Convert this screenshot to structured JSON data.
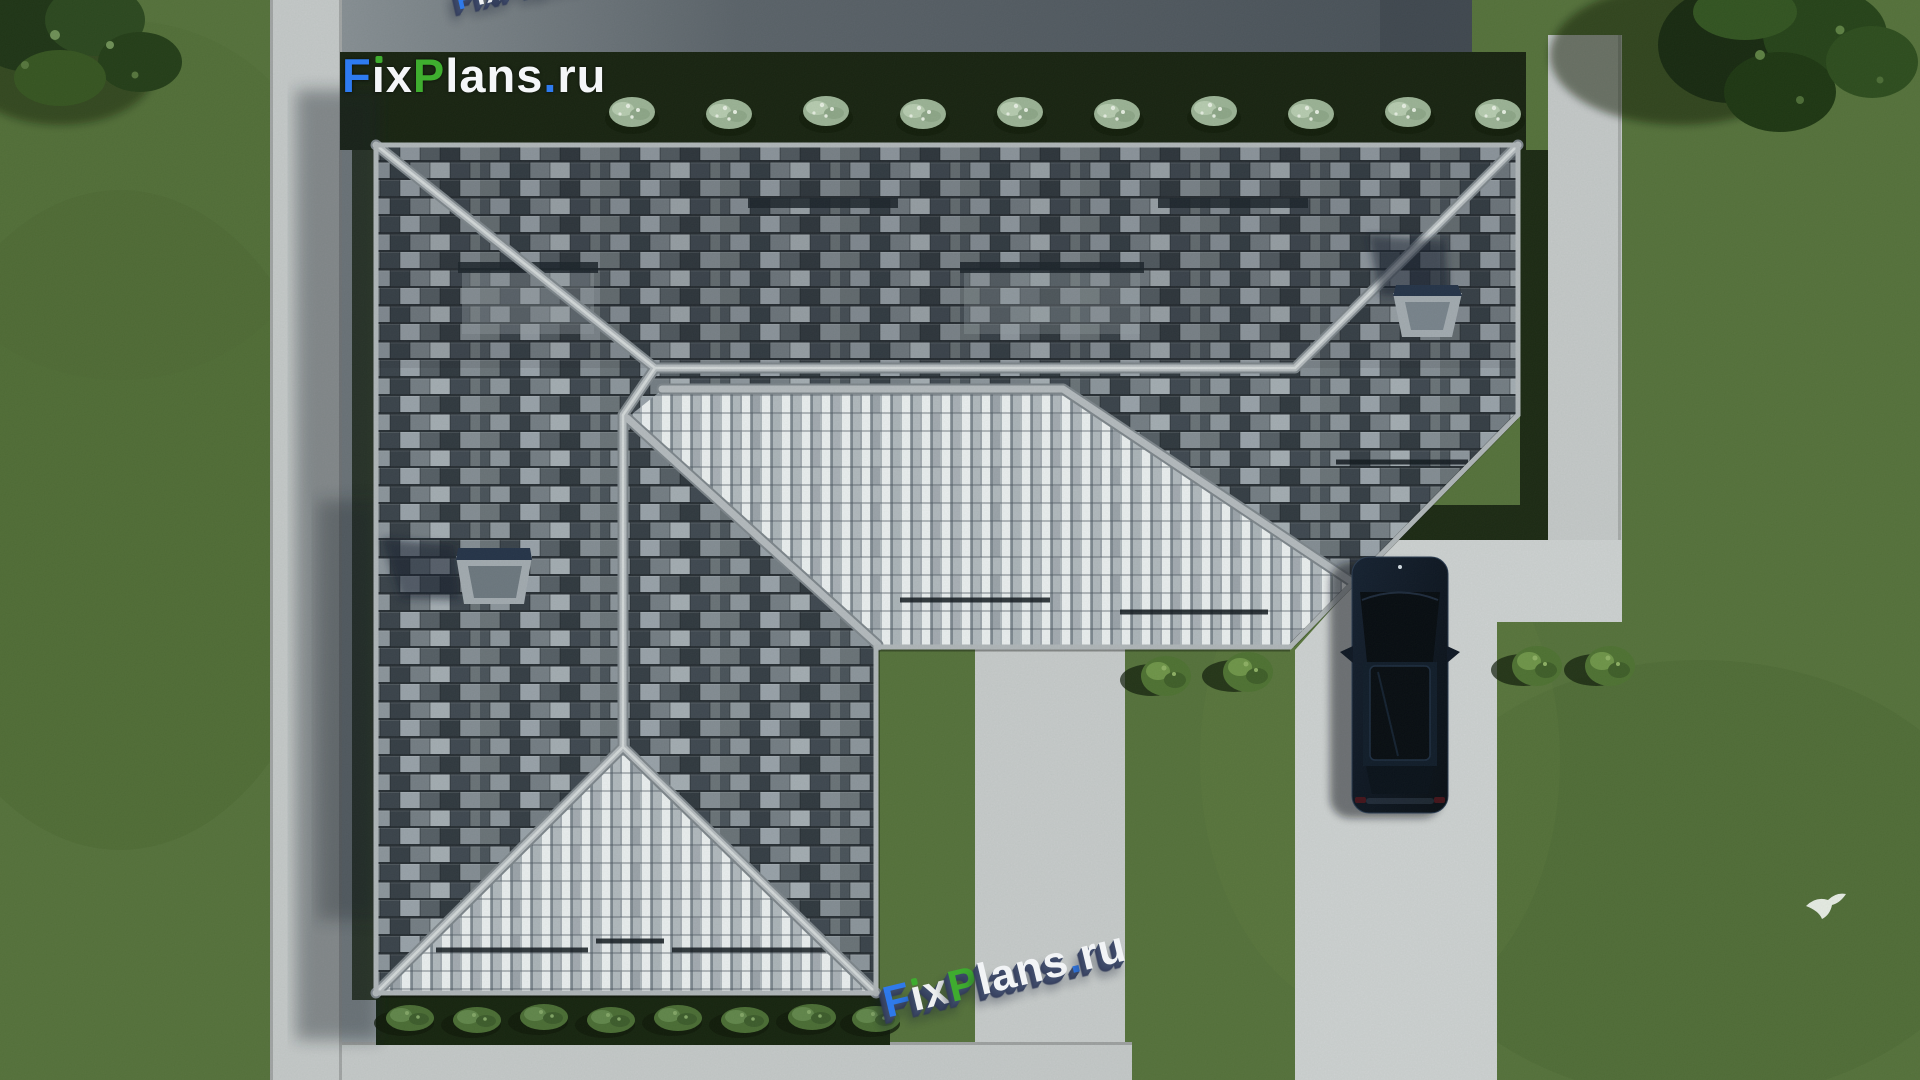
{
  "branding": {
    "text": "FixPlans.ru",
    "segments": [
      {
        "text": "F",
        "color": "#2e7bf0"
      },
      {
        "text": "i",
        "color": "#f4f6f8",
        "tittle_color": "#3fae2f"
      },
      {
        "text": "x",
        "color": "#f4f6f8"
      },
      {
        "text": "P",
        "color": "#3fae2f"
      },
      {
        "text": "lans",
        "color": "#f4f6f8"
      },
      {
        "text": ".",
        "color": "#2e7bf0"
      },
      {
        "text": "ru",
        "color": "#f4f6f8"
      }
    ]
  },
  "watermarks": {
    "ground_bottom": {
      "text": "FixPlans.ru",
      "style": "3d-extruded",
      "extrude_color": "#3a4764"
    },
    "ground_top_partial": {
      "text": "FixPlans.ru",
      "style": "3d-extruded-clipped",
      "extrude_color": "#3a4764"
    }
  },
  "scene": {
    "colors": {
      "grass": "#55703a",
      "grass_shade": "#47612f",
      "road": "#575d66",
      "sidewalk": "#c7c9cb",
      "driveway": "#d0d2d4",
      "walkway": "#c9cbcd",
      "hedge": "#161f0e",
      "roof_tile_dark": "#3c434d",
      "roof_tile_mid": "#868d97",
      "roof_tile_light": "#e8eaed",
      "ridge": "#b6bac0",
      "skylight_frame": "#a4aab2",
      "skylight_glass": "#233048",
      "car_body": "#0d1422",
      "shadow": "#131a28",
      "shrub_light": "#9db397",
      "bush_green": "#4a6b33",
      "tree_dark": "#223a16",
      "bird": "#f2f4f1"
    }
  }
}
